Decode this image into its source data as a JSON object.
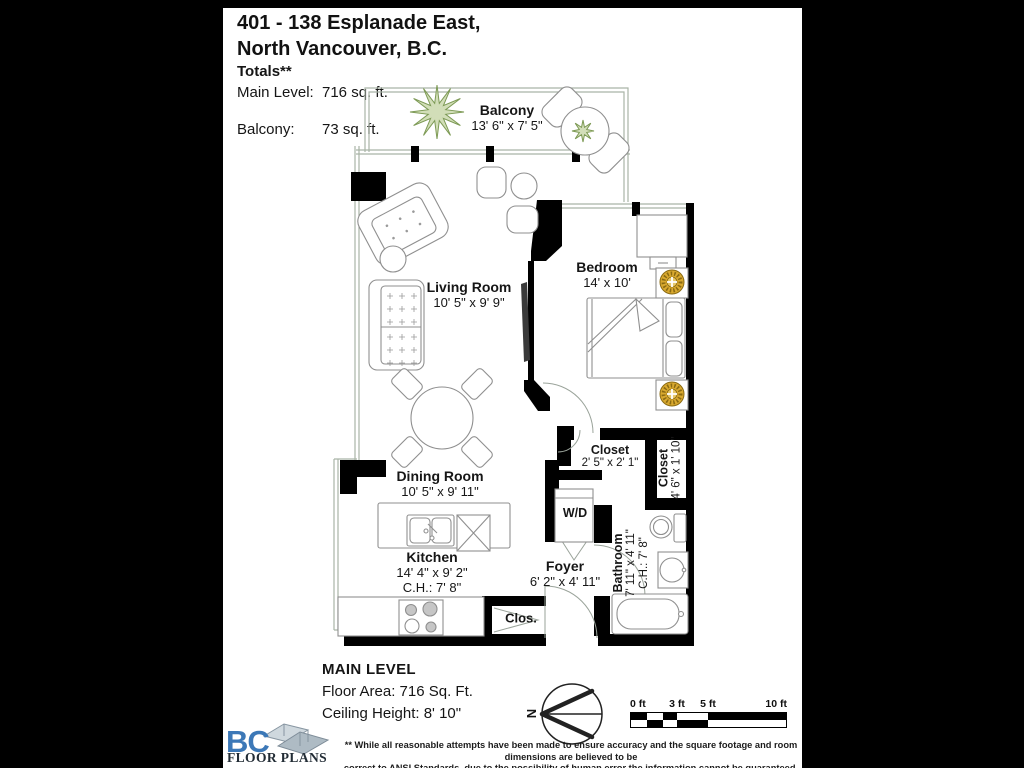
{
  "header": {
    "title_line1": "401 - 138 Esplanade East,",
    "title_line2": "North Vancouver, B.C."
  },
  "totals": {
    "heading": "Totals**",
    "main_level_label": "Main Level:",
    "main_level_value": "716 sq. ft.",
    "balcony_label": "Balcony:",
    "balcony_value": "73  sq. ft."
  },
  "rooms": {
    "balcony": {
      "name": "Balcony",
      "dims": "13' 6\" x 7' 5\""
    },
    "living": {
      "name": "Living Room",
      "dims": "10' 5\" x 9' 9\""
    },
    "bedroom": {
      "name": "Bedroom",
      "dims": "14' x 10'"
    },
    "closet1": {
      "name": "Closet",
      "dims": "2' 5\" x 2' 1\""
    },
    "closet2": {
      "name": "Closet",
      "dims": "4' 6\" x 1' 10\""
    },
    "dining": {
      "name": "Dining Room",
      "dims": "10' 5\" x 9' 11\""
    },
    "kitchen": {
      "name": "Kitchen",
      "dims": "14' 4\" x 9' 2\"",
      "ceiling": "C.H.: 7' 8\""
    },
    "foyer": {
      "name": "Foyer",
      "dims": "6' 2\" x 4' 11\""
    },
    "bathroom": {
      "name": "Bathroom",
      "dims": "7' 11\" x 4' 11\"",
      "ceiling": "C.H.: 7' 8\""
    },
    "washer_dryer": {
      "name": "W/D"
    },
    "closet3": {
      "name": "Clos."
    }
  },
  "footer": {
    "level": "MAIN LEVEL",
    "floor_area": "Floor Area: 716 Sq. Ft.",
    "ceiling_height": "Ceiling Height: 8' 10\"",
    "compass": "N",
    "scale": {
      "t0": "0 ft",
      "t3": "3 ft",
      "t5": "5 ft",
      "t10": "10 ft"
    },
    "logo": {
      "bc": "BC",
      "text": "FLOOR PLANS"
    },
    "disclaimer_line1": "** While all reasonable attempts have been made to ensure accuracy and the square footage and room dimensions are believed to be",
    "disclaimer_line2": "correct to ANSI Standards, due to the possibility of human error the information cannot be guaranteed. E&O Insured for $1,000,000"
  },
  "colors": {
    "accent_blue": "#3c78b7",
    "plant_green": "#7d9a55",
    "lamp_gold": "#d9a92f",
    "wall_black": "#000000"
  }
}
